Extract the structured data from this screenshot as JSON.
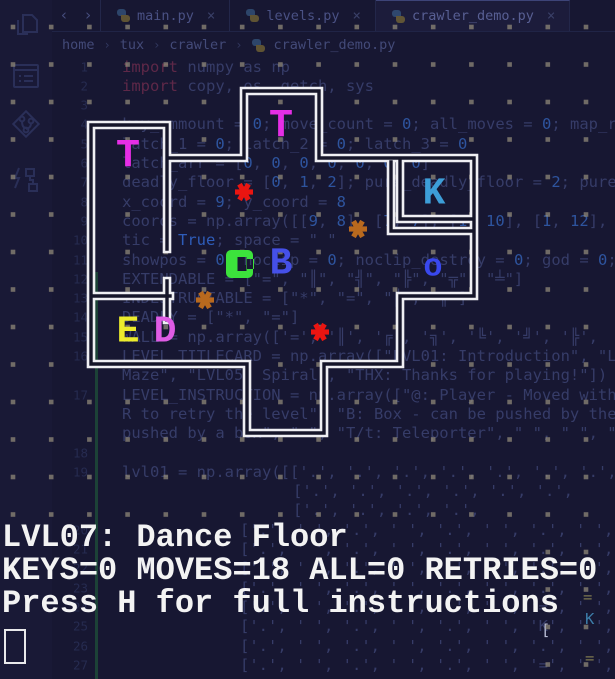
{
  "window": {
    "activity_bar": {
      "icons": [
        {
          "name": "files-icon"
        },
        {
          "name": "output-list-icon"
        },
        {
          "name": "source-control-icon"
        },
        {
          "name": "run-debug-icon"
        }
      ]
    },
    "tab_bar": {
      "nav_back": "‹",
      "nav_forward": "›",
      "tabs": [
        {
          "label": "main.py",
          "close": "×",
          "active": false
        },
        {
          "label": "levels.py",
          "close": "×",
          "active": false
        },
        {
          "label": "crawler_demo.py",
          "close": "×",
          "active": true
        }
      ]
    },
    "breadcrumb": {
      "separator": "›",
      "items": [
        "home",
        "tux",
        "crawler"
      ],
      "file": "crawler_demo.py"
    }
  },
  "editor": {
    "rows": [
      {
        "n": "1",
        "y": 66.5,
        "x": 122,
        "text": "import numpy as np"
      },
      {
        "n": "2",
        "y": 85.8,
        "x": 122,
        "text": "import copy, os, getch, sys"
      },
      {
        "n": "3",
        "y": 105.1,
        "x": 122,
        "text": ""
      },
      {
        "n": "4",
        "y": 124.4,
        "x": 122,
        "text": "key_ammount = 0; move_count = 0; all_moves = 0; map_r"
      },
      {
        "n": "5",
        "y": 143.7,
        "x": 122,
        "text": "latch_1 = 0; latch_2 = 0; latch_3 = 0"
      },
      {
        "n": "6",
        "y": 163.0,
        "x": 122,
        "text": "latch_arr = [0, 0, 0, 0, 0, 0, 0]"
      },
      {
        "n": "7",
        "y": 182.3,
        "x": 122,
        "text": "deadly_floor = [0, 1, 2]; pure_deadly_floor = 2; pure"
      },
      {
        "n": "8",
        "y": 201.6,
        "x": 122,
        "text": "x_coord = 9; y_coord = 8"
      },
      {
        "n": "9",
        "y": 220.9,
        "x": 122,
        "text": "coords = np.array([[9, 8], [7, 7], [1, 10], [1, 12],"
      },
      {
        "n": "10",
        "y": 240.2,
        "x": 122,
        "text": "tic = True; space = \" \""
      },
      {
        "n": "11",
        "y": 259.5,
        "x": 122,
        "text": "showpos = 0; noclip = 0; noclip_destroy = 0; god = 0;"
      },
      {
        "n": "12",
        "y": 278.8,
        "x": 122,
        "text": "EXTENDABLE = [\"=\", \"║\", \"╣\", \"╠\", \"╦\", \"╧\"]"
      },
      {
        "n": "13",
        "y": 298.1,
        "x": 122,
        "text": "INDESTRUCTABLE = [\"*\", \"=\", \"║\", \"╦\"]"
      },
      {
        "n": "14",
        "y": 317.4,
        "x": 122,
        "text": "DEADLY = [\"*\", \"=\"]"
      },
      {
        "n": "15",
        "y": 336.7,
        "x": 122,
        "text": "WALL = np.array(['=', '║', '╔', '╗', '╚', '╝', '╠',"
      },
      {
        "n": "16",
        "y": 356.0,
        "x": 122,
        "text": "LEVEL_TITLECARD = np.array([\"LVL01: Introduction\", \"L"
      },
      {
        "n": "",
        "y": 375.3,
        "x": 122,
        "text": "Maze\", \"LVL05: Spiral\", \"THX: Thanks for playing!\"])"
      },
      {
        "n": "17",
        "y": 394.6,
        "x": 122,
        "text": "LEVEL_INSTRUCTION = np.array([\"@: Player - Moved with"
      },
      {
        "n": "",
        "y": 413.9,
        "x": 122,
        "text": "R to retry the level\", \"B: Box - can be pushed by the"
      },
      {
        "n": "",
        "y": 433.2,
        "x": 122,
        "text": "pushed by a box\", \" \", \"T/t: Teleporter\", \" \", \" \", \""
      },
      {
        "n": "18",
        "y": 452.5,
        "x": 122,
        "text": ""
      },
      {
        "n": "19",
        "y": 471.8,
        "x": 122,
        "text": "lvl01 = np.array([['.', '.', '.', '.', '.', '.', '.',"
      },
      {
        "n": "",
        "y": 491.1,
        "x": 293,
        "text": "['.', '.', '.', '.', '.', '.',"
      },
      {
        "n": "",
        "y": 510.4,
        "x": 293,
        "text": "['.', '.', '.', '.',"
      },
      {
        "n": "20",
        "y": 529.7,
        "x": 240,
        "text": "['.', ' ', '.', ' ', '.', ' ', '.', ' ', '.', ' ', '.'],"
      },
      {
        "n": "21",
        "y": 549.0,
        "x": 240,
        "text": "['.', ' ', '.', ' ', '.', ' ', '.', ' ', '.', ' ', '.'],"
      },
      {
        "n": "22",
        "y": 568.3,
        "x": 240,
        "text": "['.', ' ', '.', ' ', '.', ' ', '.', ' ', '.', ' ', '.'],"
      },
      {
        "n": "23",
        "y": 587.6,
        "x": 240,
        "text": "['.', ' ', '.', ' ', '.', ' ', '.', ' ', '.', ' ', '.'],"
      },
      {
        "n": "24",
        "y": 606.9,
        "x": 240,
        "text": "['.', ' ', '.', ' ', '.', ' ', '=', ' ', '.', ' ', '.'],"
      },
      {
        "n": "25",
        "y": 626.2,
        "x": 240,
        "text": "['.', ' ', '.', ' ', '.', ' ', 'K', ' ', '.', ' ', '.'],"
      },
      {
        "n": "26",
        "y": 645.5,
        "x": 240,
        "text": "['.', ' ', '.', ' ', '.', ' ', '.', ' ', '.', ' ', '.'],"
      },
      {
        "n": "27",
        "y": 664.8,
        "x": 240,
        "text": "['.', ' ', '.', ' ', '.', ' ', '=', ' ', '.', ' ', '.'],"
      }
    ],
    "fragments": [
      {
        "x": 541,
        "y": 630,
        "text": "[",
        "color": "#b9bdd6"
      },
      {
        "x": 583,
        "y": 597,
        "text": "=",
        "color": "#7d7750"
      },
      {
        "x": 585,
        "y": 619,
        "text": "K",
        "color": "#3c7ca8"
      },
      {
        "x": 585,
        "y": 658,
        "text": "=",
        "color": "#7d7750"
      }
    ]
  },
  "terminal_game": {
    "dots": {
      "x0": 13,
      "y0": 27,
      "dx": 38.2,
      "dy": 37.5,
      "size": 4.6,
      "color": "#938c7a",
      "opacity": 0.72,
      "skip_below_y": 515,
      "skip_left_of_x": 525
    },
    "wall_color": "#efeff3",
    "wall_inner_color": "#151529",
    "walls": [
      [
        91,
        125,
        167,
        125
      ],
      [
        91,
        125,
        91,
        364
      ],
      [
        91,
        364,
        247,
        364
      ],
      [
        247,
        364,
        247,
        433
      ],
      [
        247,
        433,
        324,
        433
      ],
      [
        324,
        433,
        324,
        364
      ],
      [
        324,
        364,
        400,
        364
      ],
      [
        400,
        364,
        400,
        296
      ],
      [
        400,
        296,
        474,
        296
      ],
      [
        474,
        296,
        474,
        158
      ],
      [
        319,
        158,
        474,
        158
      ],
      [
        319,
        158,
        319,
        91
      ],
      [
        244,
        91,
        319,
        91
      ],
      [
        244,
        91,
        244,
        158
      ],
      [
        167,
        158,
        244,
        158
      ],
      [
        167,
        125,
        167,
        249
      ],
      [
        167,
        281,
        167,
        320
      ],
      [
        91,
        296,
        170,
        296
      ],
      [
        400,
        158,
        400,
        219
      ],
      [
        400,
        219,
        474,
        219
      ],
      [
        391,
        162,
        391,
        231
      ],
      [
        391,
        231,
        474,
        231
      ]
    ],
    "entities": [
      {
        "name": "teleporter",
        "ch": "T",
        "x": 281,
        "y": 127,
        "color": "#e62ee6",
        "size": 40
      },
      {
        "name": "teleporter",
        "ch": "T",
        "x": 128,
        "y": 157,
        "color": "#e62ee6",
        "size": 40
      },
      {
        "name": "key",
        "ch": "K",
        "x": 434,
        "y": 194,
        "color": "#3d9ed8",
        "size": 38
      },
      {
        "name": "box",
        "ch": "B",
        "x": 281,
        "y": 264,
        "color": "#4550e8",
        "size": 38
      },
      {
        "name": "hole",
        "ch": "o",
        "x": 433,
        "y": 267,
        "color": "#3948ee",
        "size": 32
      },
      {
        "name": "exit",
        "ch": "E",
        "x": 128,
        "y": 332,
        "color": "#ecec2c",
        "size": 38
      },
      {
        "name": "door",
        "ch": "D",
        "x": 165,
        "y": 332,
        "color": "#df5ce5",
        "size": 38
      }
    ],
    "stars": [
      {
        "name": "deadly-star",
        "x": 244,
        "y": 192,
        "color": "#ea1511"
      },
      {
        "name": "deadly-star",
        "x": 320,
        "y": 332,
        "color": "#ea1511"
      },
      {
        "name": "breakable-star",
        "x": 358,
        "y": 229,
        "color": "#b8691e"
      },
      {
        "name": "breakable-star",
        "x": 205,
        "y": 300,
        "color": "#b8691e"
      }
    ],
    "player": {
      "symbol": "@",
      "x": 242,
      "y": 264,
      "color": "#3ce23c"
    },
    "status": {
      "lines": [
        "LVL07: Dance Floor",
        "KEYS=0 MOVES=18 ALL=0 RETRIES=0",
        "Press H for full instructions"
      ],
      "color": "#f3f3f3"
    },
    "cursor": {
      "x": 4,
      "y": 629,
      "w": 18,
      "h": 31
    }
  },
  "colors": {
    "background": "#171732",
    "wall": "#efeff3",
    "code_text": "#363c68",
    "keyword": "#5e2848",
    "number": "#2e549e",
    "gutter": "#262b50",
    "git_added_bar": "#1d4a38",
    "floor_dot": "#938c7a"
  }
}
